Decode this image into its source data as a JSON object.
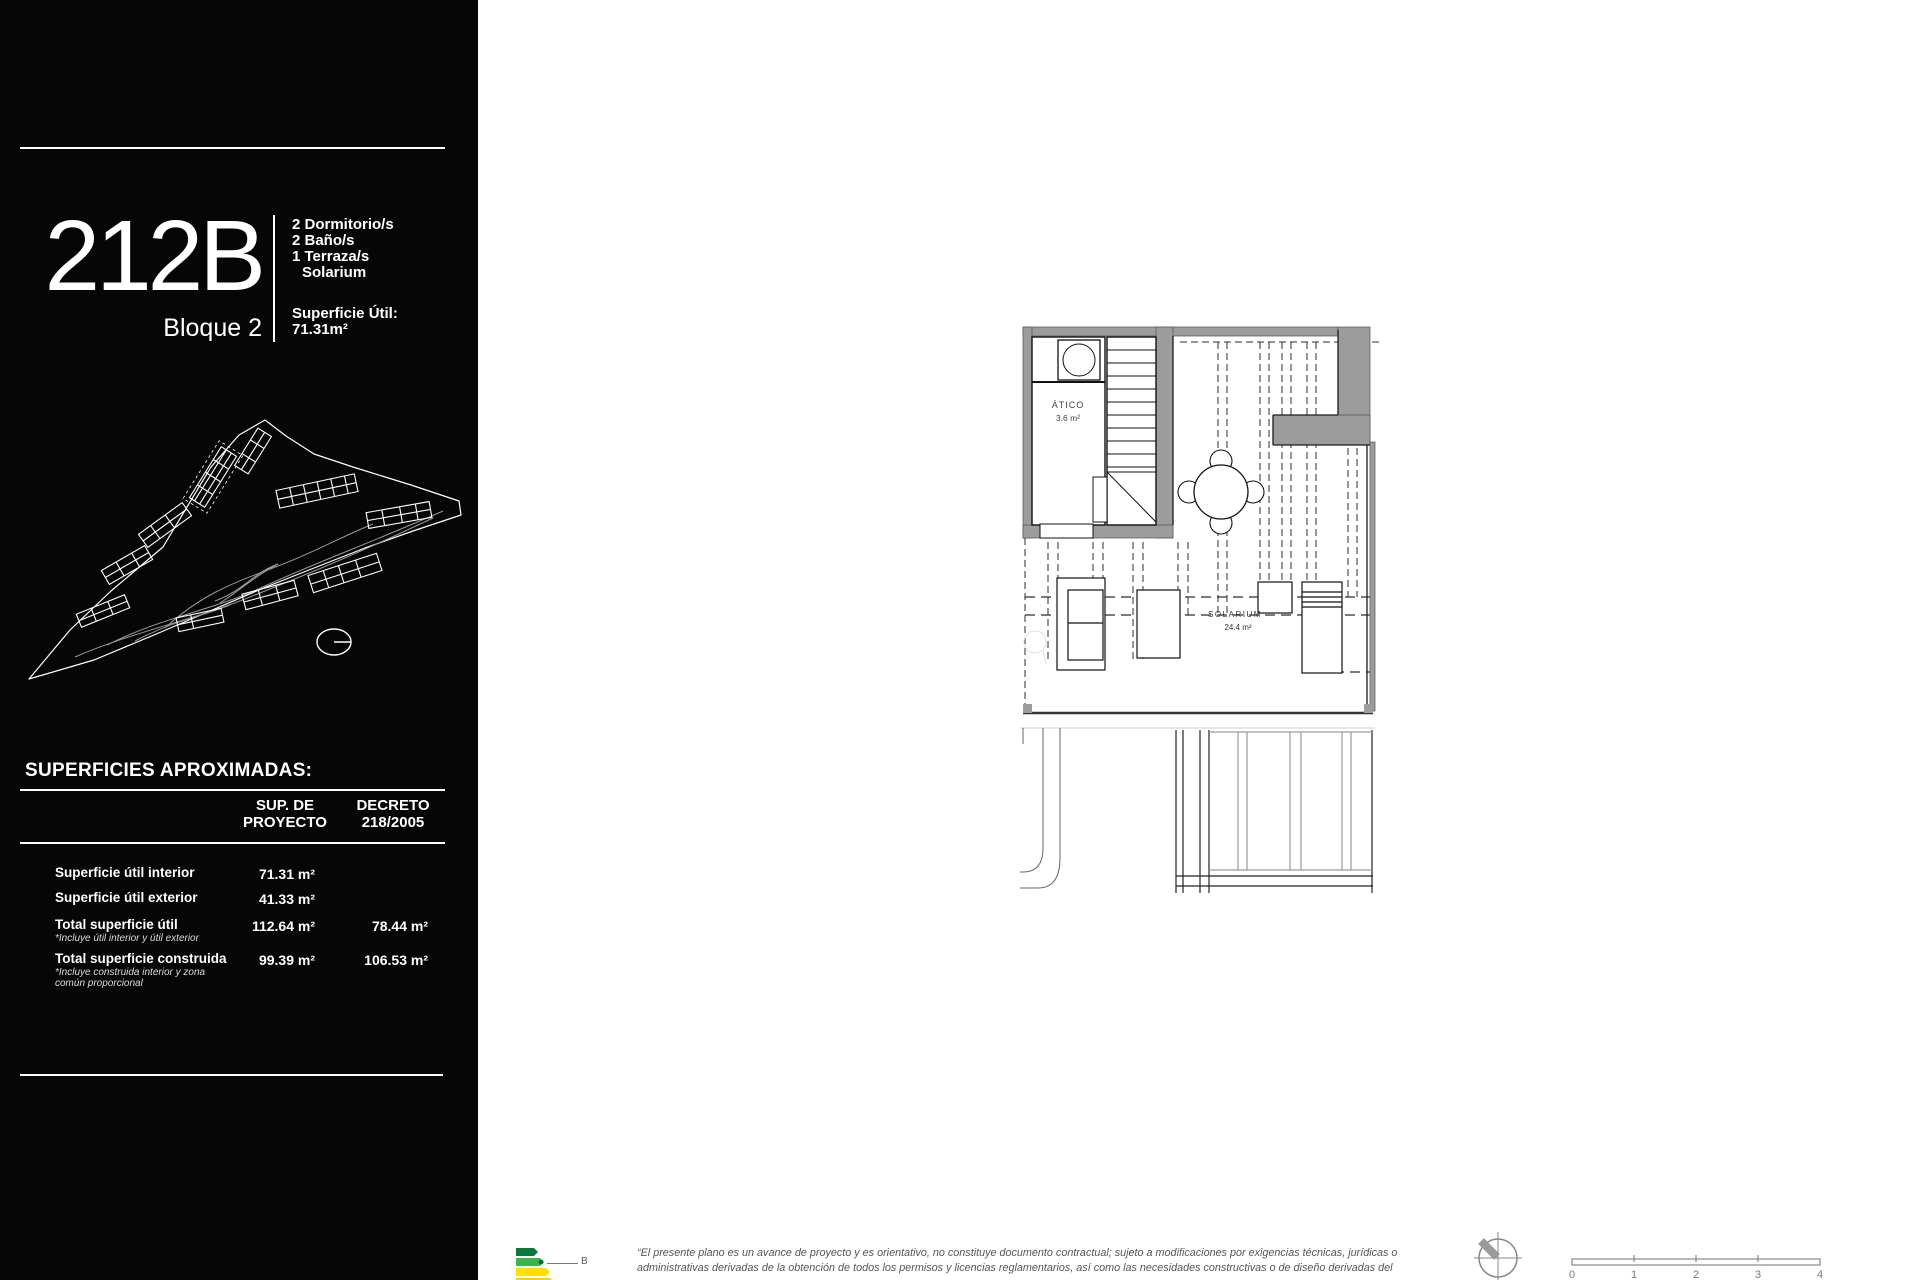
{
  "sidebar": {
    "unit_code": "212B",
    "block": "Bloque 2",
    "features": [
      "2 Dormitorio/s",
      "2 Baño/s",
      "1 Terraza/s",
      "Solarium"
    ],
    "superficie_util_label": "Superficie Útil:",
    "superficie_util_value": "71.31m²",
    "table": {
      "title": "SUPERFICIES APROXIMADAS:",
      "col_proyecto_line1": "SUP. DE",
      "col_proyecto_line2": "PROYECTO",
      "col_decreto_line1": "DECRETO",
      "col_decreto_line2": "218/2005",
      "rows": [
        {
          "label": "Superficie útil interior",
          "note": "",
          "proyecto": "71.31 m²",
          "decreto": ""
        },
        {
          "label": "Superficie útil exterior",
          "note": "",
          "proyecto": "41.33 m²",
          "decreto": ""
        },
        {
          "label": "Total superficie útil",
          "note": "*Incluye útil interior y útil exterior",
          "proyecto": "112.64 m²",
          "decreto": "78.44 m²"
        },
        {
          "label": "Total superficie construida",
          "note": "*Incluye construida interior y zona común proporcional",
          "proyecto": "99.39 m²",
          "decreto": "106.53 m²"
        }
      ]
    }
  },
  "plan": {
    "atico_label": "ÁTICO",
    "atico_area": "3.6 m²",
    "solarium_label": "SOLARIUM",
    "solarium_area": "24.4 m²"
  },
  "footer": {
    "energy_rating": "B",
    "disclaimer_line1": "“El presente plano es un avance de proyecto y es orientativo, no constituye documento contractual; sujeto a modificaciones por exigencias técnicas, jurídicas o",
    "disclaimer_line2": "administrativas derivadas de la obtención de todos los permisos y licencias  reglamentarios, así como las necesidades constructivas o de diseño derivadas del",
    "scale_ticks": [
      "0",
      "1",
      "2",
      "3",
      "4"
    ]
  },
  "colors": {
    "sidebar_bg": "#060606",
    "wall_gray": "#9c9c9c",
    "energy_green_dark": "#0a7a3c",
    "energy_green": "#3ab54a",
    "energy_yellow": "#ffe000"
  }
}
